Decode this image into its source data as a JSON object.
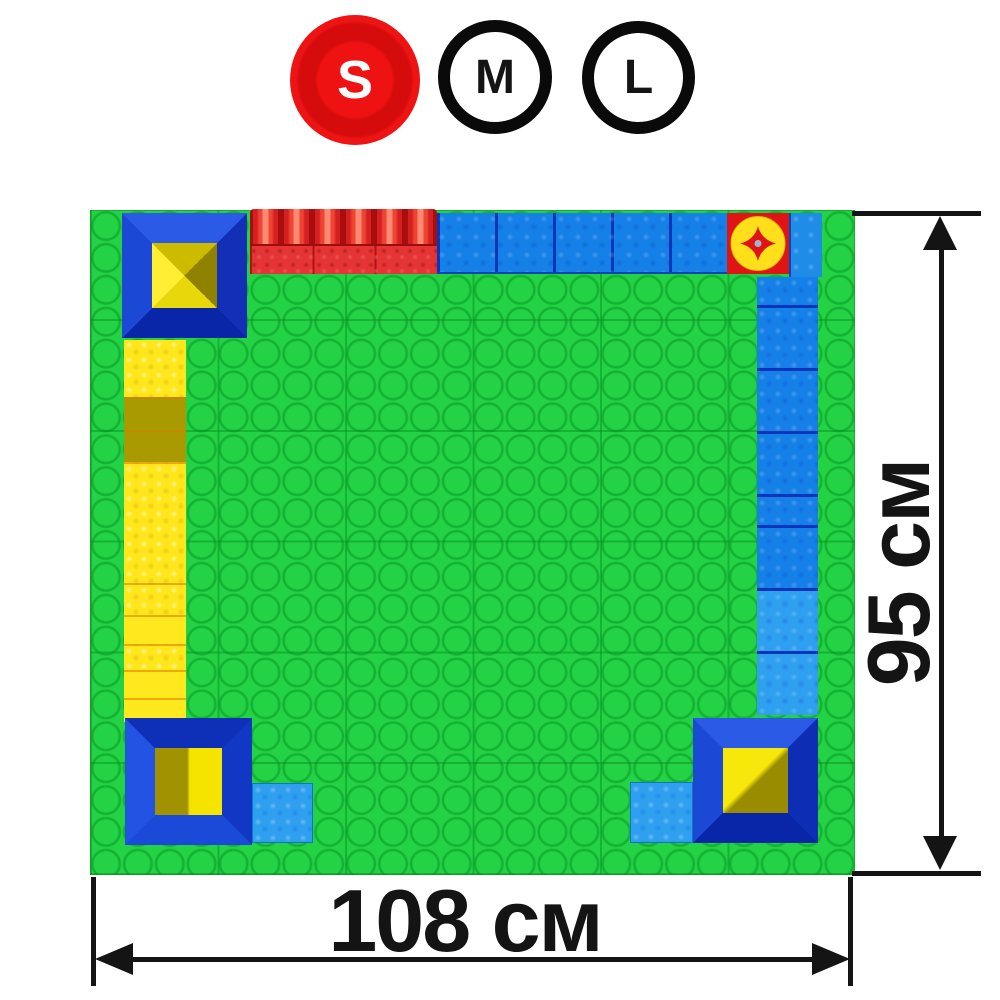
{
  "size_selector": {
    "options": [
      {
        "label": "S",
        "selected": true
      },
      {
        "label": "M",
        "selected": false
      },
      {
        "label": "L",
        "selected": false
      }
    ],
    "selected_color": "#ed1010",
    "ring_color": "#0a0a0a"
  },
  "dimensions": {
    "height": {
      "label": "95 см",
      "value": 95,
      "unit": "см"
    },
    "width": {
      "label": "108 см",
      "value": 108,
      "unit": "см"
    },
    "line_color": "#141414"
  },
  "mat": {
    "type": "building-block play mat, top view",
    "pieces": [
      "corner-tower-top-left",
      "red-ridge-blocks-top",
      "red-textured-blocks-top",
      "blue-blocks-top",
      "spinner-disc-top-right",
      "blue-block-top-right",
      "blue-strip-right",
      "yellow-strip-left",
      "corner-tower-bottom-left",
      "light-blue-block-bottom-left",
      "corner-tower-bottom-right",
      "light-blue-block-bottom-right"
    ],
    "colors": {
      "base_green": "#23d245",
      "stud_line_green": "#0f9c2e",
      "frame_blue_light": "#2a5ae6",
      "frame_blue_dark": "#0a26a8",
      "block_blue": "#1580e8",
      "light_blue": "#2f9ff0",
      "red": "#e01414",
      "yellow": "#ffe71c",
      "olive": "#a89a00"
    }
  }
}
